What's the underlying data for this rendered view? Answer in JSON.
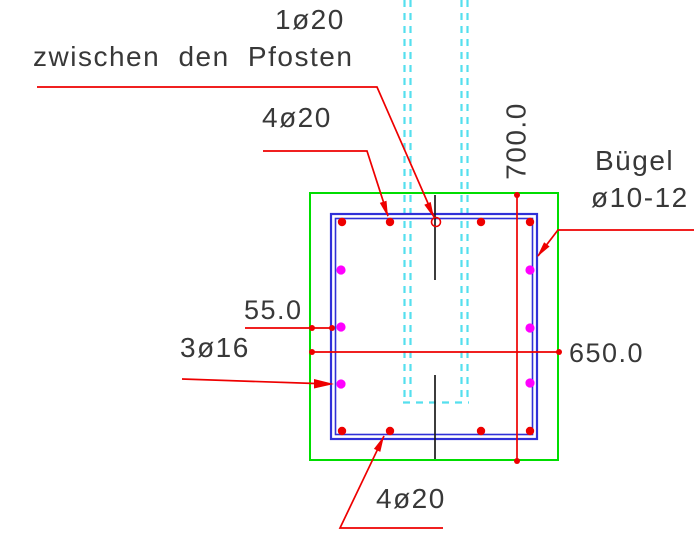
{
  "drawing_type": "reinforced-concrete-column-cross-section",
  "colors": {
    "background": "#ffffff",
    "concrete_outline": "#00dd00",
    "stirrup": "#3030d8",
    "leader": "#ee0000",
    "side_bar": "#ff00ff",
    "post": "#55dfee",
    "centerline": "#1a1a1a",
    "text": "#383838"
  },
  "annotations": {
    "post_bar": {
      "label": "1ø20",
      "sublabel": "zwischen den Pfosten"
    },
    "top_bars": {
      "label": "4ø20"
    },
    "stirrup": {
      "line1": "Bügel",
      "line2": "ø10-12"
    },
    "side_bars": {
      "label": "3ø16"
    },
    "bottom_bars": {
      "label": "4ø20"
    }
  },
  "dimensions": {
    "cover": {
      "value": "55.0"
    },
    "width": {
      "value": "650.0"
    },
    "height": {
      "value": "700.0"
    }
  }
}
